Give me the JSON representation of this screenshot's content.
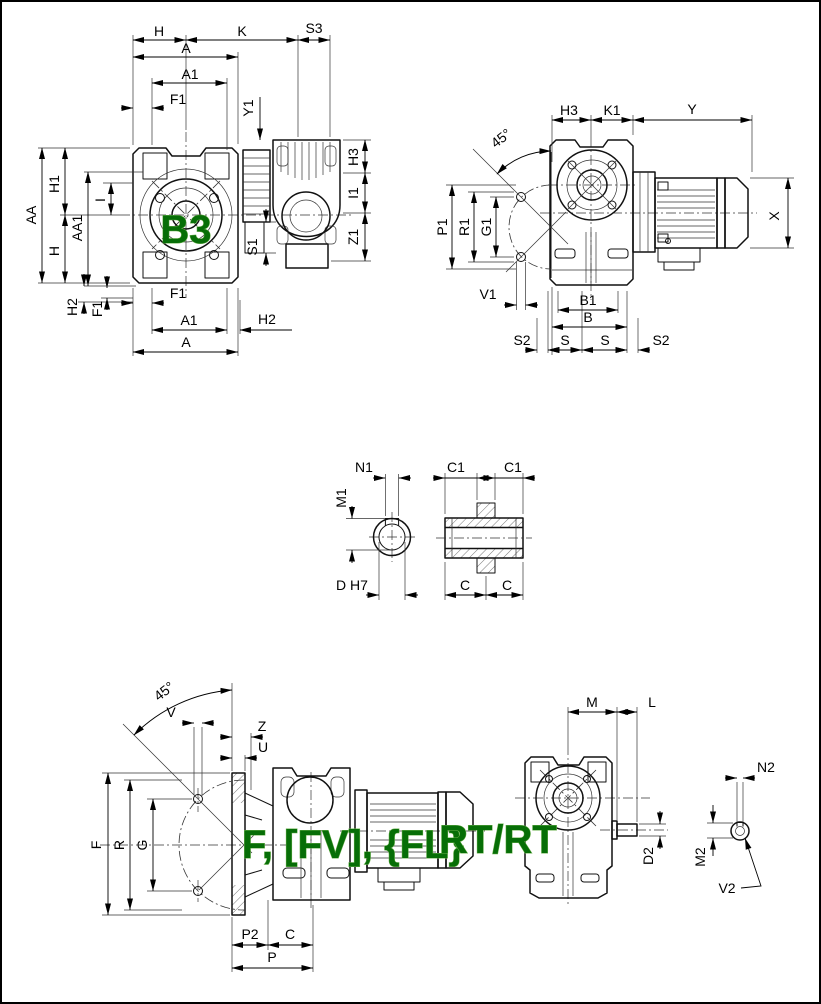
{
  "colors": {
    "line": "#000000",
    "accent_green": "#076e07",
    "background": "#ffffff"
  },
  "views": {
    "b3": {
      "title": "B3",
      "top": {
        "h": "H",
        "k": "K",
        "s3": "S3",
        "a": "A",
        "a1": "A1",
        "f1": "F1",
        "y1": "Y1"
      },
      "left": {
        "aa": "AA",
        "h1": "H1",
        "aa1": "AA1",
        "i": "I",
        "h": "H",
        "h2": "H2",
        "f1": "F1"
      },
      "right": {
        "h3": "H3",
        "i1": "I1",
        "z1": "Z1",
        "s1": "S1"
      },
      "bottom": {
        "f1": "F1",
        "a1": "A1",
        "h2": "H2",
        "a": "A"
      }
    },
    "side": {
      "angle": "45°",
      "top": {
        "h3": "H3",
        "k1": "K1",
        "y": "Y"
      },
      "left": {
        "p1": "P1",
        "r1": "R1",
        "g1": "G1"
      },
      "v1": "V1",
      "x": "X",
      "bottom": {
        "b1": "B1",
        "b": "B",
        "s2_left": "S2",
        "s_left": "S",
        "s_right": "S",
        "s2_right": "S2"
      }
    },
    "shaft_end": {
      "n1": "N1",
      "m1": "M1",
      "d": "D H7"
    },
    "shaft_section": {
      "c1_left": "C1",
      "c1_right": "C1",
      "c_left": "C",
      "c_right": "C"
    },
    "flange": {
      "title": "F, [FV], {FL}",
      "angle": "45°",
      "top": {
        "v": "V",
        "z": "Z",
        "u": "U"
      },
      "left": {
        "f": "F",
        "r": "R",
        "g": "G"
      },
      "bottom": {
        "p2": "P2",
        "c": "C",
        "p": "P"
      }
    },
    "rt": {
      "title": "RT/RT",
      "top": {
        "m": "M",
        "l": "L"
      },
      "dims": {
        "d2": "D2",
        "n2": "N2",
        "m2": "M2",
        "v2": "V2"
      }
    }
  }
}
